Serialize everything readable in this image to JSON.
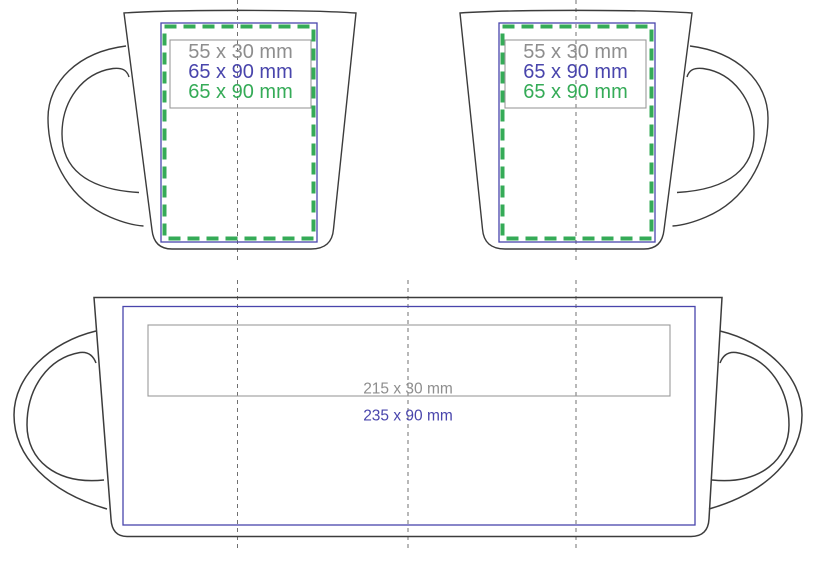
{
  "diagram": {
    "front_left": {
      "label_gray": "55 x 30 mm",
      "label_blue": "65 x 90 mm",
      "label_green": "65 x 90 mm"
    },
    "front_right": {
      "label_gray": "55 x 30 mm",
      "label_blue": "65 x 90 mm",
      "label_green": "65 x 90 mm"
    },
    "wrap": {
      "label_gray": "215 x 30 mm",
      "label_blue": "235 x 90 mm"
    }
  },
  "colors": {
    "outline": "#3c3c3c",
    "blue": "#4945ac",
    "green": "#35ab57",
    "gray_text": "#8e8e8e",
    "gray_box": "#9a9a9a",
    "centerline": "#707070"
  }
}
